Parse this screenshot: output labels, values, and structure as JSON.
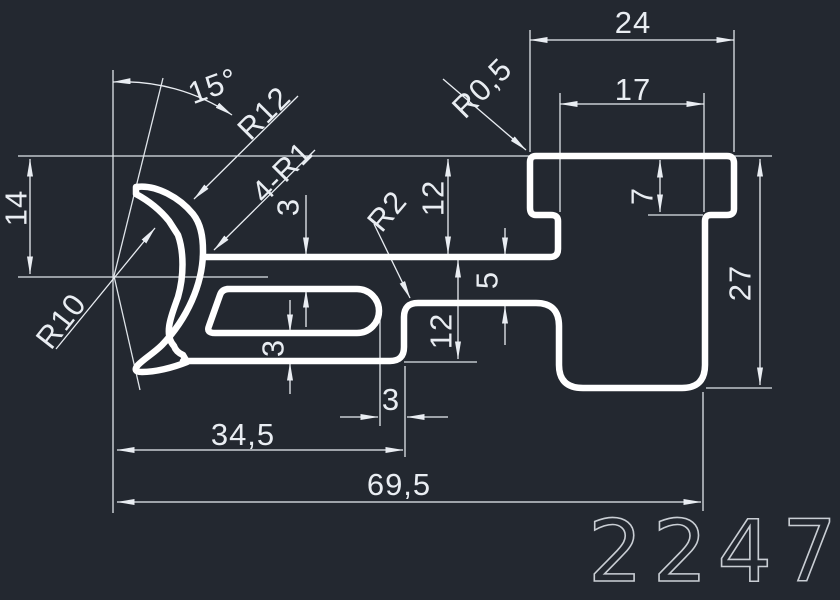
{
  "drawing": {
    "type": "cad-profile-cross-section",
    "part_number": "2247",
    "colors": {
      "background": "#232830",
      "profile_line": "#ffffff",
      "dimension_line": "#e9edf2",
      "part_number_stroke": "#c9ced4"
    },
    "dimensions": {
      "d14": "14",
      "a15": "15°",
      "r12": "R12",
      "r1x4": "4-R1",
      "t3_top": "3",
      "r2": "R2",
      "d12_upper": "12",
      "d5": "5",
      "d12_lower": "12",
      "r05": "R0,5",
      "d24": "24",
      "d17": "17",
      "d7": "7",
      "d27": "27",
      "r10": "R10",
      "t3_bottom": "3",
      "d3_step": "3",
      "d34_5": "34,5",
      "d69_5": "69,5"
    }
  }
}
